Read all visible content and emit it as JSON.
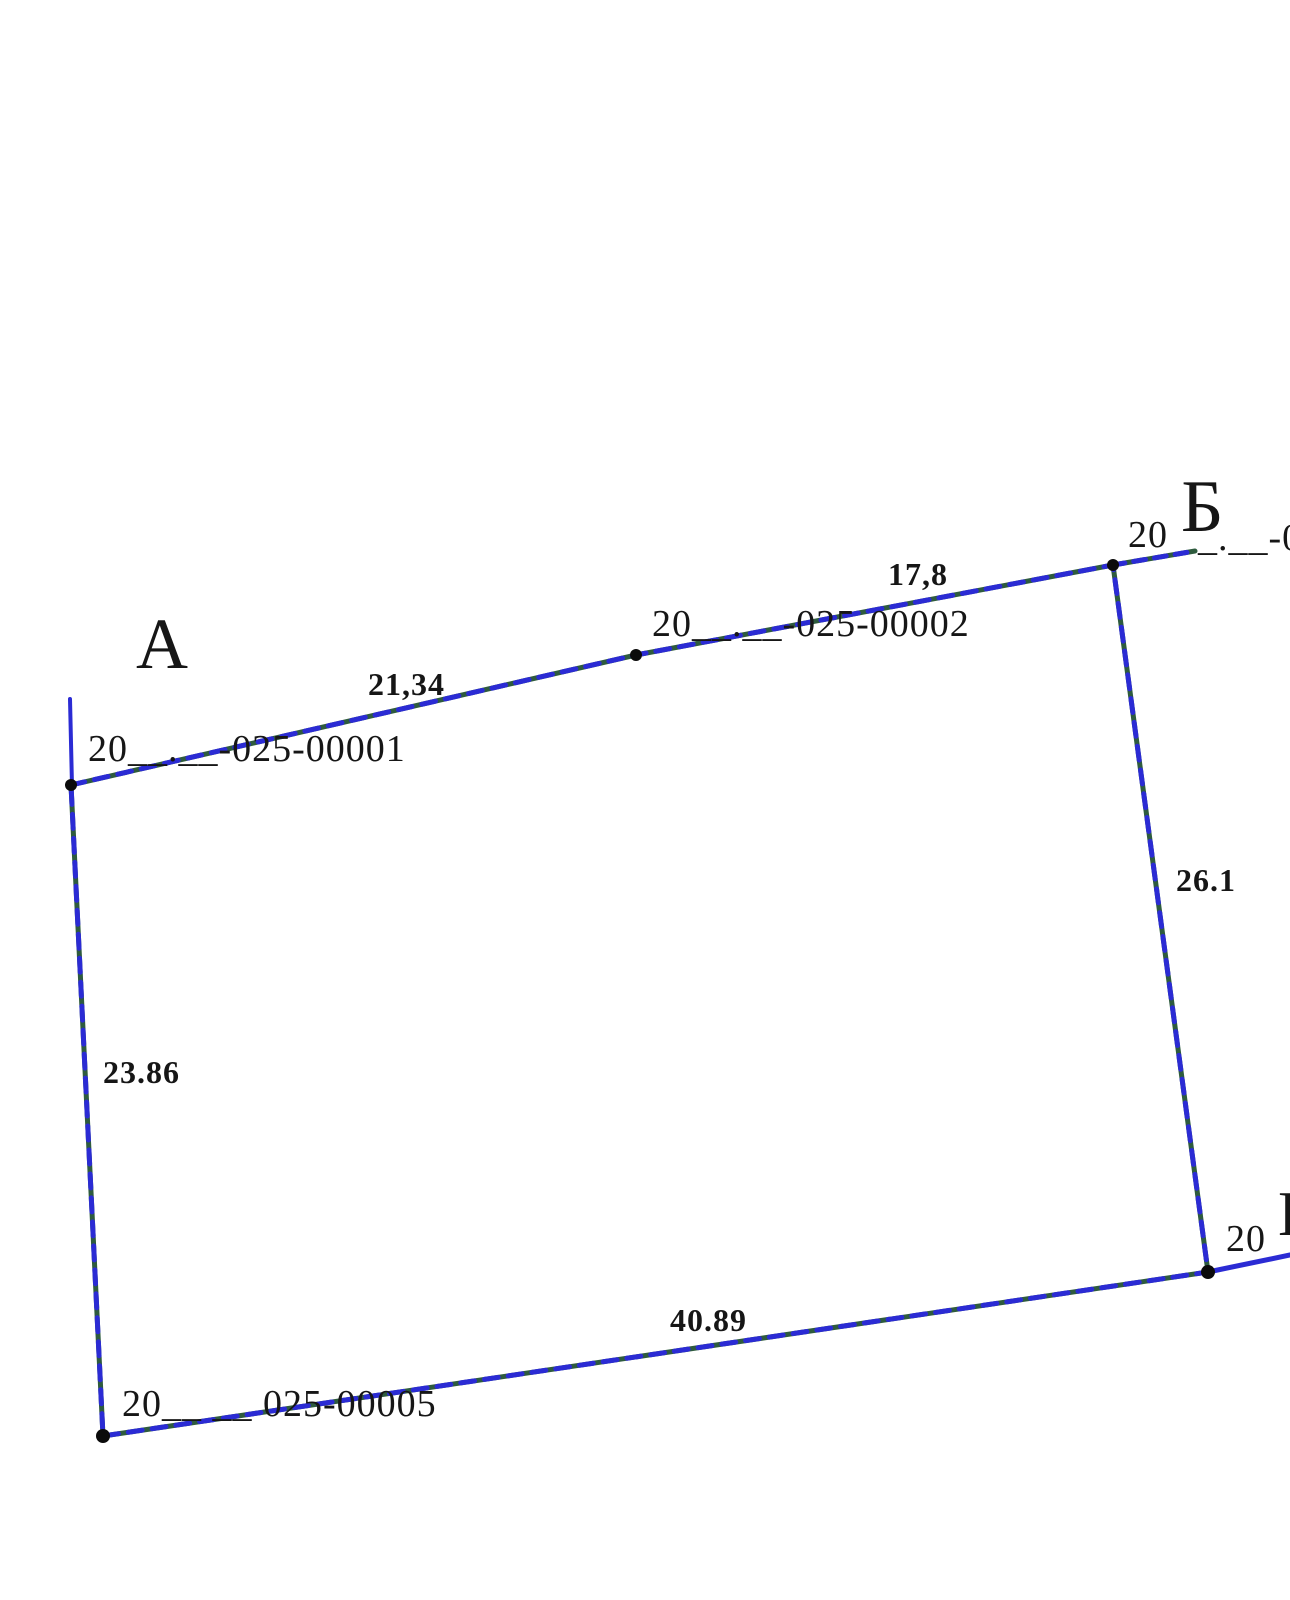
{
  "plan": {
    "description": "cadastral parcel boundary plan",
    "background": "#ffffff",
    "colors": {
      "boundary_green": "#2e5b3e",
      "boundary_blue": "#2b2bd4",
      "extension_blue": "#2b2bd4",
      "vertex_dot": "#0b0b0b",
      "text": "#161616"
    },
    "vertices": {
      "a": "А",
      "b": "Б",
      "v": "В"
    },
    "lengths": {
      "a_to_mid": "21,34",
      "mid_to_b": "17,8",
      "b_to_v": "26.1",
      "v_to_sw": "40.89",
      "sw_to_a": "23.86"
    },
    "cadastral_numbers": {
      "parcel_1": "20__.__-025-00001",
      "parcel_2": "20__.__-025-00002",
      "parcel_b_prefix": "20",
      "parcel_b_suffix": "_.__-0",
      "parcel_v_prefix": "20",
      "parcel_5": "20__ __ 025-00005"
    }
  }
}
